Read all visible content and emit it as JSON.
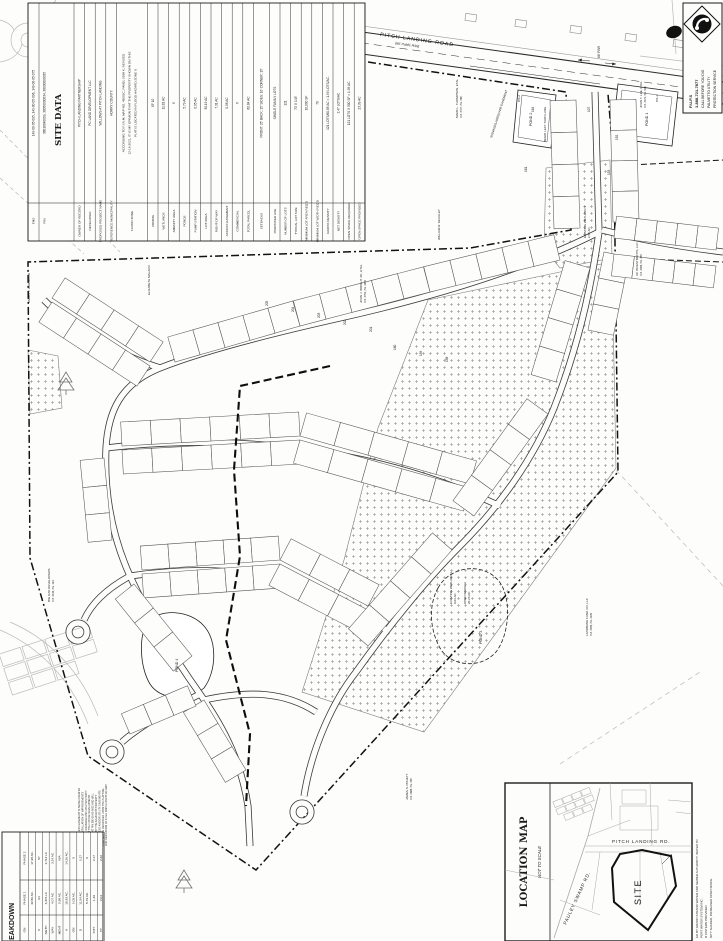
{
  "site_data_table": {
    "title": "SITE DATA",
    "rows": [
      {
        "label": "TMS",
        "value": "149-00-05-095, 149-00-05-096, 149-00-05-075"
      },
      {
        "label": "PIN",
        "value": "38016040009, 38050000034, 38000000035"
      },
      {
        "label": "OWNER OF RECORD",
        "value": "PITCH LANDING PARTNERSHIP"
      },
      {
        "label": "DEVELOPER",
        "value": "PC LAND DEVELOPMENT LLC"
      },
      {
        "label": "PROPOSED PROJECT NAME",
        "value": "WILLOWS AT PITCH LANDING"
      },
      {
        "label": "REFERENCE MUNICIPALITY",
        "value": "HORRY COUNTY"
      },
      {
        "label": "FLOOD ZONE",
        "value_lines": [
          "ACCORDING TO F.I.R.M. MAP NO. 45051C, PANEL 0538 K, REVISED",
          "12-16-2021, IT IS MY OPINION THAT THE PROPERTY SHOWN ON THIS",
          "PLAT IS LOCATED IN FLOOD HAZARD ZONE X"
        ]
      },
      {
        "label": "ZONING",
        "value": "SF 10"
      },
      {
        "label": "WETLANDS",
        "value": "11.81 AC"
      },
      {
        "label": "AMENITY AREA",
        "value": "X"
      },
      {
        "label": "PONDS",
        "value": "5.79 AC"
      },
      {
        "label": "PUMP STATION",
        "value": "0.05 AC"
      },
      {
        "label": "LOT AREA",
        "value": "30.19 AC"
      },
      {
        "label": "RIGHT-OF-WAY",
        "value": "7.31 AC"
      },
      {
        "label": "ACCESS EASEMENT",
        "value": "0.58 AC"
      },
      {
        "label": "COMMERCIAL",
        "value": "X"
      },
      {
        "label": "TOTAL PARCEL",
        "value": "60.84 AC"
      },
      {
        "label": "SETBACKS",
        "value": "FRONT: 25'   BACK: 15'   SIDES: 10'   CORNER: 15'"
      },
      {
        "label": "PROPOSED USE",
        "value": "SINGLE FAMILY LOTS"
      },
      {
        "label": "NUMBER OF LOTS",
        "value": "121"
      },
      {
        "label": "TYPICAL LOT SIZE",
        "value": "70' X 143'"
      },
      {
        "label": "MINIMUM LOT AREA REQ'D",
        "value": "10,000 SF"
      },
      {
        "label": "MINIMUM LOT WIDTH REQ'D",
        "value": "70"
      },
      {
        "label": "GROSS DENSITY",
        "value": "121 LOTS/60.85 AC = 1.99 LOTS/AC."
      },
      {
        "label": "NET DENSITY",
        "value": "2.47 LOTS/AC"
      },
      {
        "label": "OPEN SPACE REQUIRED",
        "value": "121 LOTS X 500 SF = 1.39 AC."
      },
      {
        "label": "OPEN SPACE PROVIDED",
        "value": "23.39 AC"
      }
    ]
  },
  "breakdown_table": {
    "heading": "BREAKDOWN",
    "rows": [
      {
        "label": "ON",
        "p1": "PHASE 1",
        "p2": "PHASE 2"
      },
      {
        "label": "",
        "p1": "42.86 AC.",
        "p2": "17.98 AC."
      },
      {
        "label": "S",
        "p1": "64",
        "p2": "57"
      },
      {
        "label": "NGTH",
        "p1": "3,376 LF.",
        "p2": "2,712 LF."
      },
      {
        "label": "WAY",
        "p1": "4.07 AC.",
        "p2": "3.24 AC."
      },
      {
        "label": "MENT",
        "p1": "0.58 AC.",
        "p2": "N/A"
      },
      {
        "label": "A",
        "p1": "15.93 AC.",
        "p2": "14.26 AC."
      },
      {
        "label": "ON",
        "p1": "0.05 AC.",
        "p2": "X"
      },
      {
        "label": "D",
        "p1": "11.54 AC.",
        "p2": "0.27"
      },
      {
        "label": "",
        "p1": "5.79 AC.",
        "p2": "X"
      },
      {
        "label": "SITY",
        "p1": "1.49",
        "p2": "2.17"
      },
      {
        "label": "TY",
        "p1": "2.04",
        "p2": "2.22"
      }
    ]
  },
  "pups": {
    "lines": [
      "P.U.P.S",
      "1-888-721-7877",
      "CALL BEFORE YOU DIG",
      "PALMETTO UTILITY",
      "PROTECTION SERVICE"
    ]
  },
  "plat": {
    "road": {
      "name": "PITCH LANDING ROAD",
      "rw": "(66' Public R/W)"
    },
    "entrance": {
      "rw_dim": "66' R/W",
      "turn_lane": "BEGIN LEFT TURN LANE",
      "signage": "SIGNAGE/LANDSCAPE EASEMENT"
    },
    "ponds": [
      {
        "label": "POND 1",
        "os": "OS-1"
      },
      {
        "label": "POND 2",
        "os": "OS-2"
      },
      {
        "label": "POND 3",
        "os": ""
      },
      {
        "label": "POND 4",
        "os": ""
      }
    ],
    "areas": [
      {
        "line1": "EXISTING WETLAND 1",
        "line2": "2.52 AC."
      },
      {
        "line1": "EXISTING WETLAND 3",
        "line2": "9.03 AC."
      },
      {
        "line1": "OPEN SPACE 3",
        "line2": "20.26 AC."
      }
    ],
    "owners": [
      {
        "name": "MARK L. THOMPSON, ETAL",
        "ref": "D.B. 3727, PG. 588"
      },
      {
        "name": "WILLIAM R. McAULEY",
        "ref": ""
      },
      {
        "name": "JOHN T. LEE, ETAL",
        "ref": "D.B. 3471, PG. 916"
      },
      {
        "name": "JOHN J. WRIGHT JR., ETAL",
        "ref": "D.B. 3761, PG. 2485"
      },
      {
        "name": "JAMES J. HARWOOD",
        "ref": ""
      },
      {
        "name": "ELIZABETH MALACO",
        "ref": ""
      },
      {
        "name": "AC INVESTMENTS, LLC",
        "ref": "D.B. 4386, PG. 399"
      },
      {
        "name": "LANDBANK FUND XIV, LLC",
        "ref": "D.B. 3999, PG. 2199"
      },
      {
        "name": "JAMES S. PRUETT",
        "ref": "D.B. 2888, PG. 336"
      },
      {
        "name": "BIG OAK DEVELOPERS",
        "ref": "D.B. 4019, PG. 124"
      }
    ],
    "lot_numbers": [
      "164",
      "161",
      "107",
      "152",
      "153",
      "205",
      "204",
      "203",
      "202",
      "201",
      "160",
      "159",
      "158"
    ],
    "easement_note_lines": [
      "THE 50' ACCESS EASEMENT IS BEING CREATED",
      "FOR THE INSTALLATION OF IMPROVEMENTS",
      "(I.E. ROADS, DRAINAGE AND UTILITIES) BOTH",
      "BY AND FOR THE FUTURE DEVELOPMENT",
      "OF ADJACENT PIN 380-00-00-0002 AND WILL",
      "BE OWNED BY THE ADJACENT PROPERTY",
      "OWNER. THESE AND/OR UTILITY EASEMENTS",
      "THAT MAY BE RECORDED UPON THE PLATTING",
      "AND DEDICATION OF A FEE SIMPLE RIGHT-OF-WAY"
    ]
  },
  "location_map": {
    "title": "LOCATION MAP",
    "subtitle": "NOT TO SCALE",
    "road1": "PITCH LANDING RD.",
    "road2": "PAULEY SWAMP RD.",
    "site_label": "SITE",
    "side_note_lines": [
      "ED BY GRAND STRAND WATER AND SEWER AUTHORITY. WATER TO",
      "PORT WATER SYSTEM INC.",
      "R CISTERN PROVIDED",
      "NITY SHADED, INCREASED OPEN SPACE"
    ]
  }
}
